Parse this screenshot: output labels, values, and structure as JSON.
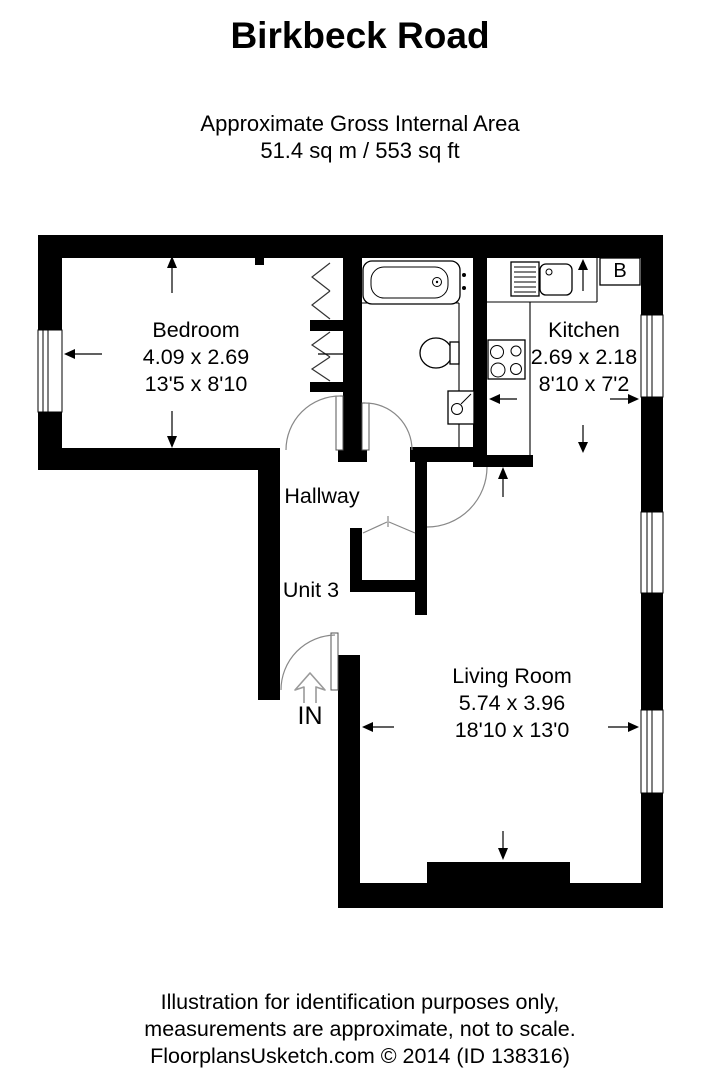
{
  "title": "Birkbeck Road",
  "subtitle": {
    "line1": "Approximate Gross Internal Area",
    "line2": "51.4 sq m / 553 sq ft"
  },
  "rooms": {
    "bedroom": {
      "name": "Bedroom",
      "metric": "4.09 x 2.69",
      "imperial": "13'5 x 8'10"
    },
    "kitchen": {
      "name": "Kitchen",
      "metric": "2.69 x 2.18",
      "imperial": "8'10 x 7'2"
    },
    "living_room": {
      "name": "Living Room",
      "metric": "5.74 x 3.96",
      "imperial": "18'10 x 13'0"
    },
    "hallway": {
      "name": "Hallway"
    },
    "unit": {
      "name": "Unit 3"
    }
  },
  "markers": {
    "entrance": "IN",
    "boiler": "B"
  },
  "footer": {
    "line1": "Illustration for identification purposes only,",
    "line2": "measurements are approximate, not to scale.",
    "line3": "FloorplansUsketch.com © 2014 (ID 138316)"
  },
  "colors": {
    "wall": "#000000",
    "door_arc": "#888888",
    "background": "#ffffff"
  }
}
